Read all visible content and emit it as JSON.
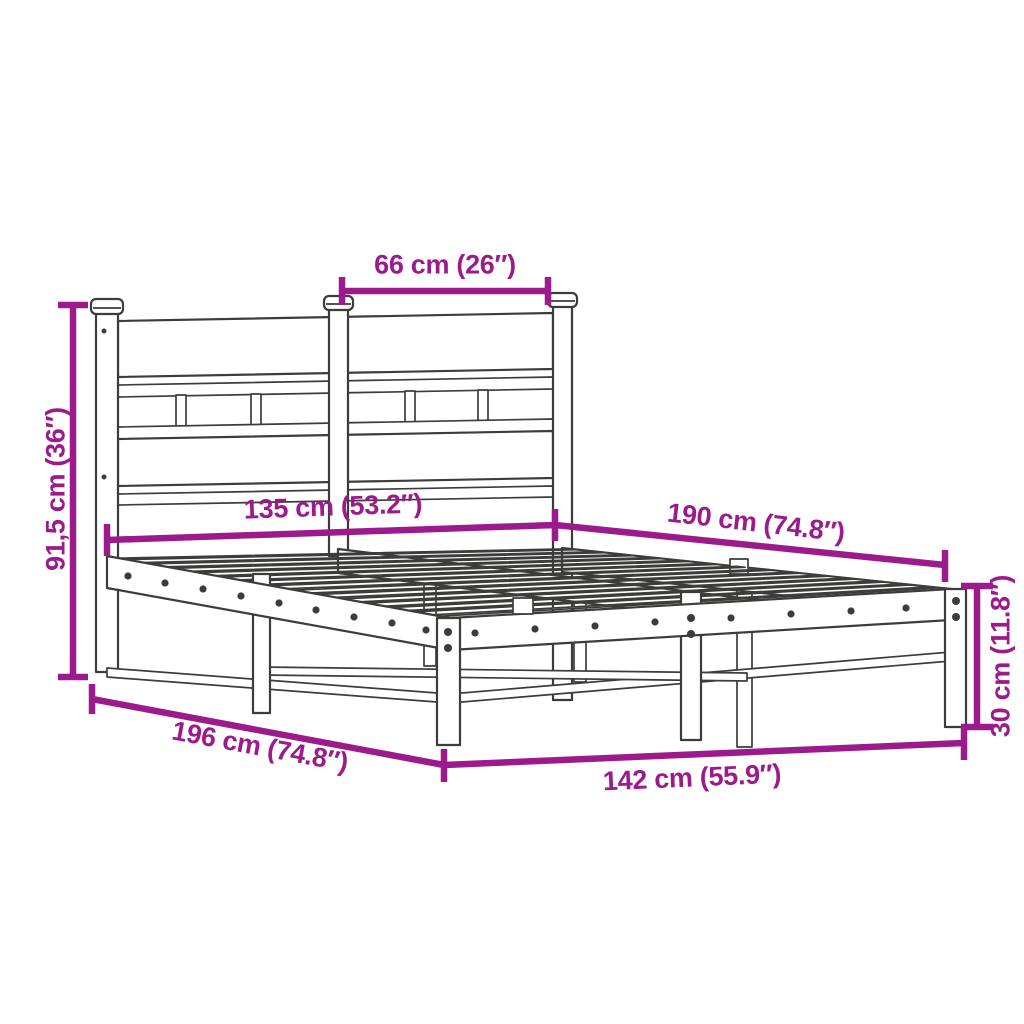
{
  "diagram": {
    "accent_color": "#9c1b8c",
    "line_color": "#3c3c3a",
    "background_color": "#ffffff",
    "dimensions": [
      {
        "id": "headboard-panel-width",
        "label": "66 cm (26″)"
      },
      {
        "id": "frame-width",
        "label": "135 cm (53.2″)"
      },
      {
        "id": "frame-length",
        "label": "190 cm (74.8″)"
      },
      {
        "id": "headboard-height",
        "label": "91,5 cm (36″)"
      },
      {
        "id": "total-length",
        "label": "196 cm (74.8″)"
      },
      {
        "id": "total-width",
        "label": "142 cm (55.9″)"
      },
      {
        "id": "base-height",
        "label": "30 cm (11.8″)"
      }
    ]
  }
}
